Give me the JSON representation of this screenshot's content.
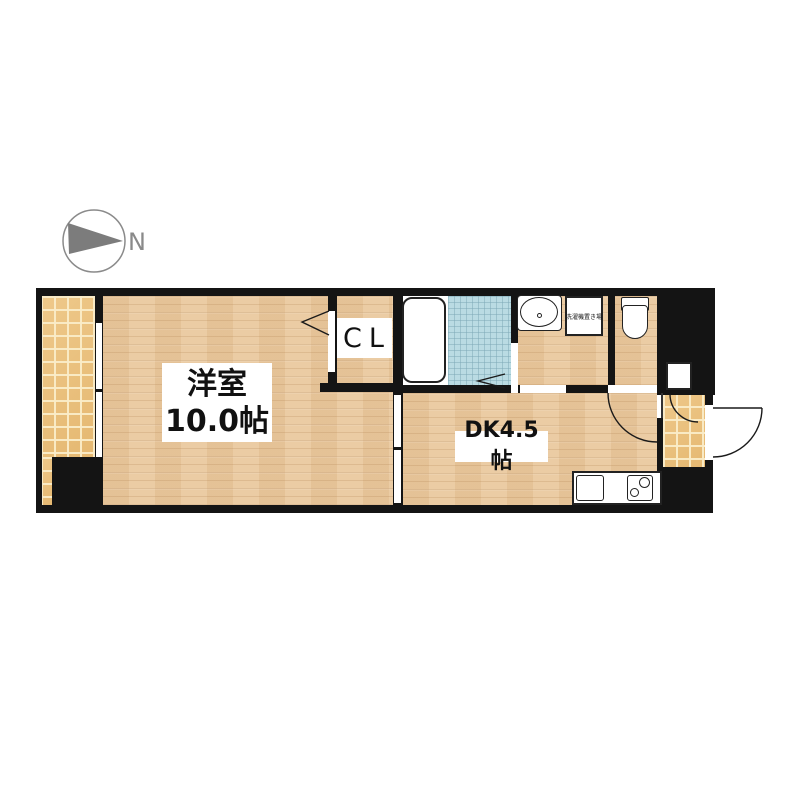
{
  "floorplan": {
    "compass": {
      "north_label": "N"
    },
    "rooms": {
      "living": {
        "line1": "洋室",
        "line2": "10.0帖"
      },
      "dk": {
        "label": "DK4.5帖"
      },
      "closet": {
        "label": "CL"
      },
      "laundry": {
        "label": "洗濯機置き場"
      }
    },
    "colors": {
      "wall": "#141414",
      "wood_floor": "#e9c89e",
      "tile_floor": "#ecc17a",
      "bath_tile": "#badbe3",
      "compass_gray": "#8a8a8a",
      "background": "#ffffff"
    }
  }
}
